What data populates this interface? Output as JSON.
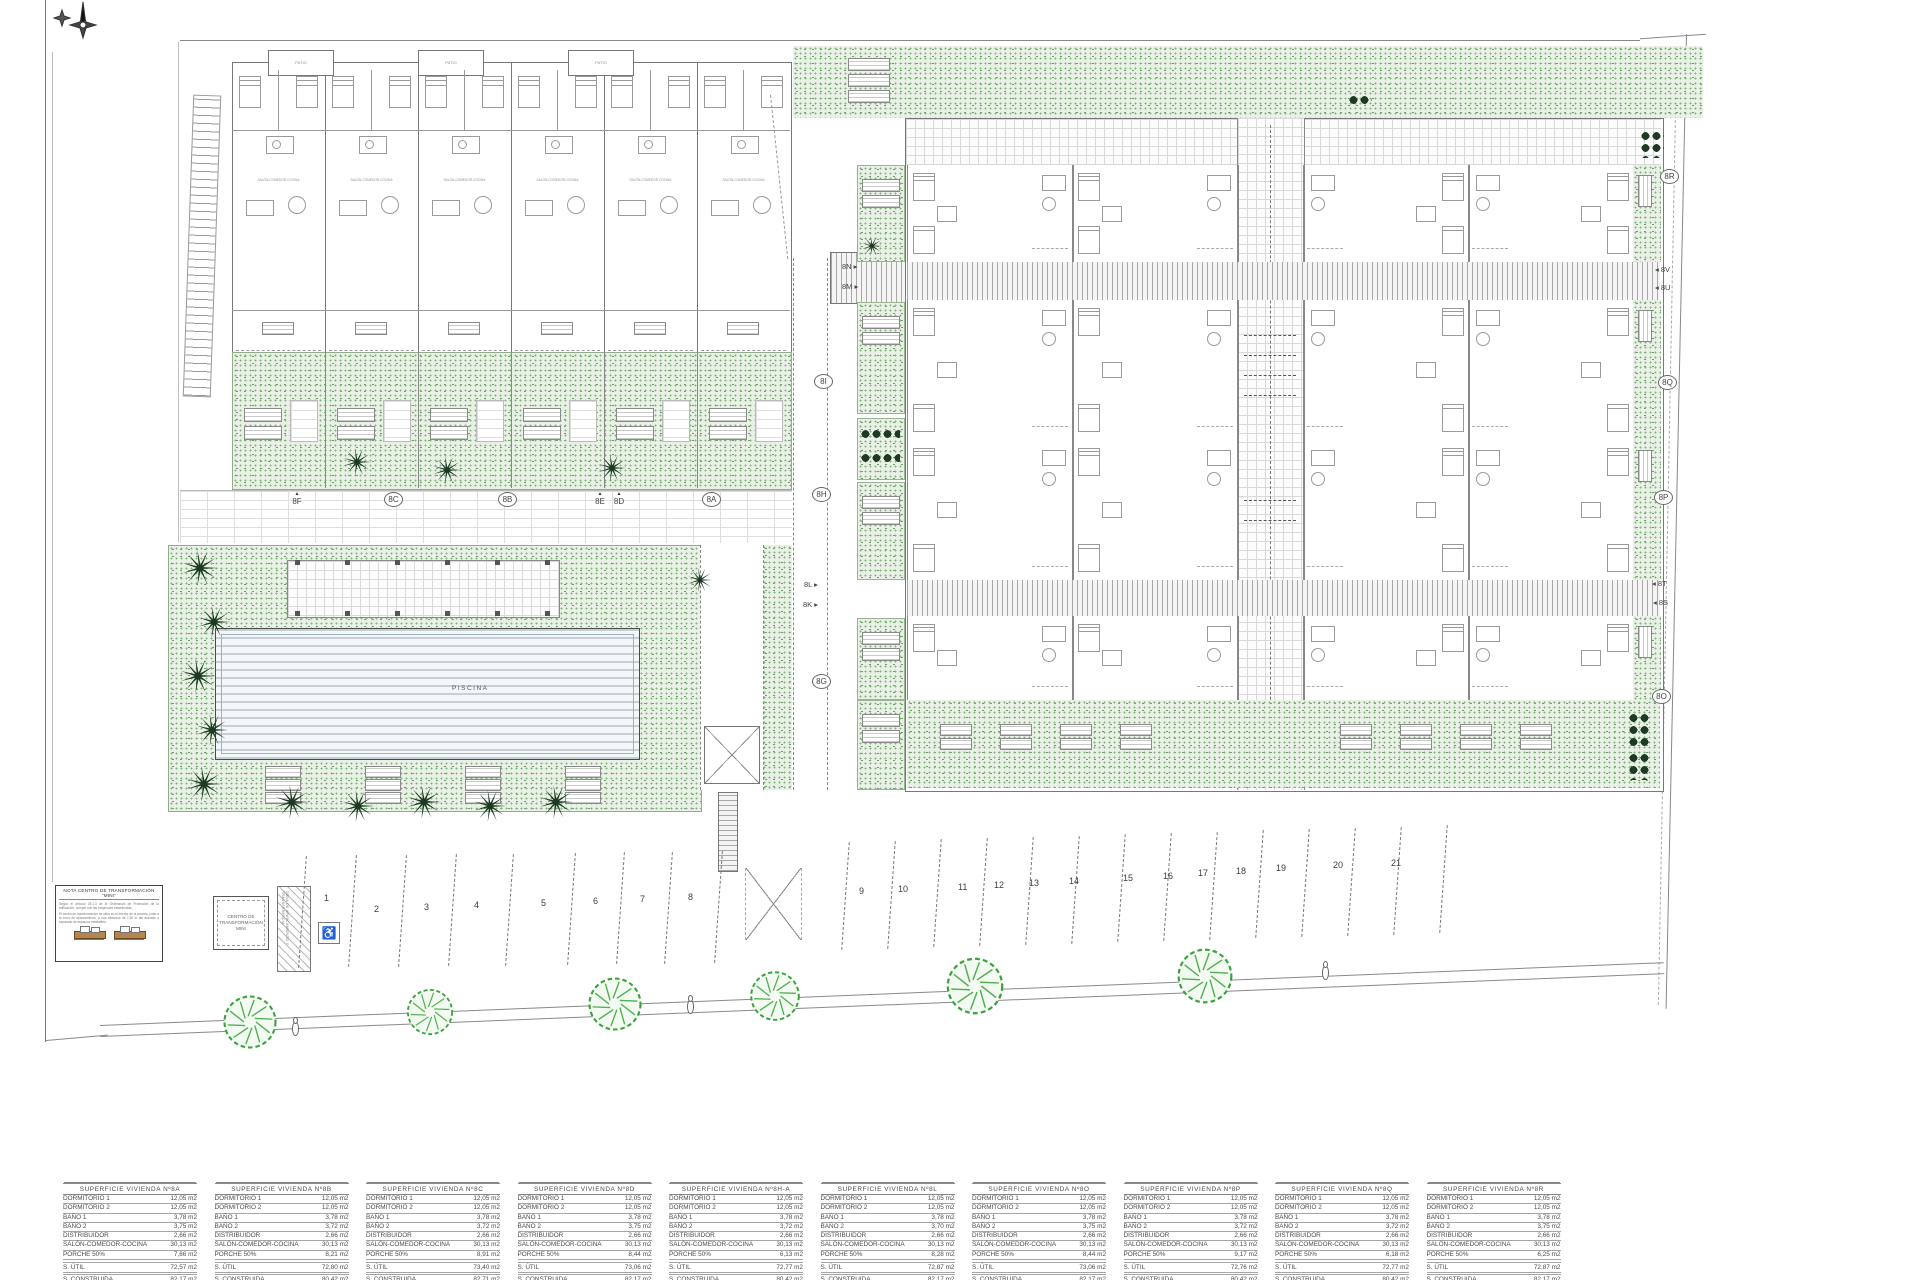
{
  "note_box": {
    "title": "NOTA CENTRO DE TRANSFORMACIÓN \"MINI\"",
    "par1": "Según el artículo 26.1.3 de la Ordenanza de Protección de la edificación, cumple con las exigencias establecidas.",
    "par2": "El centro de transformación se sitúa en el interior de la parcela, junto a la zona de aparcamiento, a una distancia de 1,50 m del acerado y separado de espacios habitables."
  },
  "transformer_label": "CENTRO DE TRANSFORMACIÓN MINI",
  "hatch_label": "ZONA DE APARCAMIENTO Y TRANSFERENCIA",
  "pool_label": "PISCINA",
  "patio_label": "PATIO",
  "salon_label": "SALÓN-COMEDOR-COCINA",
  "acera_label": "ACERA PERIMETRAL 2%",
  "parcel_label": "22",
  "compass_icon": "compass-north-icon",
  "wheelchair_symbol": "♿",
  "unit_labels": [
    {
      "text": "8F",
      "style": "tri",
      "x": 289,
      "y": 492
    },
    {
      "text": "8C",
      "style": "circle",
      "x": 384,
      "y": 492
    },
    {
      "text": "8B",
      "style": "circle",
      "x": 498,
      "y": 492
    },
    {
      "text": "8E",
      "style": "tri",
      "x": 592,
      "y": 492
    },
    {
      "text": "8D",
      "style": "tri",
      "x": 611,
      "y": 492
    },
    {
      "text": "8A",
      "style": "circle",
      "x": 702,
      "y": 492
    },
    {
      "text": "8N",
      "style": "arrow-r",
      "x": 842,
      "y": 262
    },
    {
      "text": "8M",
      "style": "arrow-r",
      "x": 842,
      "y": 282
    },
    {
      "text": "8I",
      "style": "circle",
      "x": 814,
      "y": 374
    },
    {
      "text": "8H",
      "style": "circle",
      "x": 812,
      "y": 487
    },
    {
      "text": "8L",
      "style": "arrow-r",
      "x": 804,
      "y": 580
    },
    {
      "text": "8K",
      "style": "arrow-r",
      "x": 803,
      "y": 600
    },
    {
      "text": "8G",
      "style": "circle",
      "x": 812,
      "y": 674
    },
    {
      "text": "8R",
      "style": "circle",
      "x": 1660,
      "y": 169
    },
    {
      "text": "8V",
      "style": "arrow-l",
      "x": 1655,
      "y": 265
    },
    {
      "text": "8U",
      "style": "arrow-l",
      "x": 1655,
      "y": 283
    },
    {
      "text": "8Q",
      "style": "circle",
      "x": 1658,
      "y": 375
    },
    {
      "text": "8P",
      "style": "circle",
      "x": 1654,
      "y": 490
    },
    {
      "text": "8T",
      "style": "arrow-l",
      "x": 1652,
      "y": 579
    },
    {
      "text": "8S",
      "style": "arrow-l",
      "x": 1653,
      "y": 598
    },
    {
      "text": "8O",
      "style": "circle",
      "x": 1652,
      "y": 689
    }
  ],
  "parking_numbers": [
    {
      "n": "1",
      "x": 328,
      "y": 899
    },
    {
      "n": "2",
      "x": 378,
      "y": 910
    },
    {
      "n": "3",
      "x": 428,
      "y": 908
    },
    {
      "n": "4",
      "x": 478,
      "y": 906
    },
    {
      "n": "5",
      "x": 545,
      "y": 904
    },
    {
      "n": "6",
      "x": 597,
      "y": 902
    },
    {
      "n": "7",
      "x": 644,
      "y": 900
    },
    {
      "n": "8",
      "x": 692,
      "y": 898
    },
    {
      "n": "9",
      "x": 863,
      "y": 892
    },
    {
      "n": "10",
      "x": 902,
      "y": 890
    },
    {
      "n": "11",
      "x": 962,
      "y": 888
    },
    {
      "n": "12",
      "x": 998,
      "y": 886
    },
    {
      "n": "13",
      "x": 1033,
      "y": 884
    },
    {
      "n": "14",
      "x": 1073,
      "y": 882
    },
    {
      "n": "15",
      "x": 1127,
      "y": 879
    },
    {
      "n": "16",
      "x": 1167,
      "y": 877
    },
    {
      "n": "17",
      "x": 1202,
      "y": 874
    },
    {
      "n": "18",
      "x": 1240,
      "y": 872
    },
    {
      "n": "19",
      "x": 1280,
      "y": 869
    },
    {
      "n": "20",
      "x": 1337,
      "y": 866
    },
    {
      "n": "21",
      "x": 1395,
      "y": 864
    }
  ],
  "area_tables": {
    "row_labels": [
      "DORMITORIO 1",
      "DORMITORIO 2",
      "BAÑO 1",
      "BAÑO 2",
      "DISTRIBUIDOR",
      "SALÓN-COMEDOR-COCINA",
      "PORCHE   50%",
      "S. ÚTIL",
      "S. CONSTRUIDA"
    ],
    "tables": [
      {
        "title": "SUPERFICIE VIVIENDA Nº8A",
        "values": [
          "12,05 m2",
          "12,05 m2",
          "3,78 m2",
          "3,75 m2",
          "2,66 m2",
          "30,13 m2",
          "7,66 m2",
          "72,57 m2",
          "82,17 m2"
        ]
      },
      {
        "title": "SUPERFICIE VIVIENDA Nº8B",
        "values": [
          "12,05 m2",
          "12,05 m2",
          "3,78 m2",
          "3,72 m2",
          "2,66 m2",
          "30,13 m2",
          "8,21 m2",
          "72,80 m2",
          "80,42 m2"
        ]
      },
      {
        "title": "SUPERFICIE VIVIENDA Nº8C",
        "values": [
          "12,05 m2",
          "12,05 m2",
          "3,78 m2",
          "3,72 m2",
          "2,66 m2",
          "30,13 m2",
          "8,91 m2",
          "73,40 m2",
          "82,71 m2"
        ]
      },
      {
        "title": "SUPERFICIE VIVIENDA Nº8D",
        "values": [
          "12,05 m2",
          "12,05 m2",
          "3,78 m2",
          "3,75 m2",
          "2,66 m2",
          "30,13 m2",
          "8,44 m2",
          "73,06 m2",
          "82,17 m2"
        ]
      },
      {
        "title": "SUPERFICIE VIVIENDA Nº8H-A",
        "values": [
          "12,05 m2",
          "12,05 m2",
          "3,78 m2",
          "3,72 m2",
          "2,66 m2",
          "30,13 m2",
          "6,13 m2",
          "72,77 m2",
          "80,42 m2"
        ]
      },
      {
        "title": "SUPERFICIE VIVIENDA Nº8L",
        "values": [
          "12,05 m2",
          "12,05 m2",
          "3,78 m2",
          "3,70 m2",
          "2,66 m2",
          "30,13 m2",
          "8,28 m2",
          "72,87 m2",
          "82,17 m2"
        ]
      },
      {
        "title": "SUPERFICIE VIVIENDA Nº8O",
        "values": [
          "12,05 m2",
          "12,05 m2",
          "3,78 m2",
          "3,75 m2",
          "2,66 m2",
          "30,13 m2",
          "8,44 m2",
          "73,06 m2",
          "82,17 m2"
        ]
      },
      {
        "title": "SUPERFICIE VIVIENDA Nº8P",
        "values": [
          "12,05 m2",
          "12,05 m2",
          "3,78 m2",
          "3,72 m2",
          "2,66 m2",
          "30,13 m2",
          "9,17 m2",
          "72,76 m2",
          "80,42 m2"
        ]
      },
      {
        "title": "SUPERFICIE VIVIENDA Nº8Q",
        "values": [
          "12,05 m2",
          "12,05 m2",
          "3,78 m2",
          "3,72 m2",
          "2,66 m2",
          "30,13 m2",
          "6,18 m2",
          "72,77 m2",
          "80,42 m2"
        ]
      },
      {
        "title": "SUPERFICIE VIVIENDA Nº8R",
        "values": [
          "12,05 m2",
          "12,05 m2",
          "3,78 m2",
          "3,75 m2",
          "2,66 m2",
          "30,13 m2",
          "6,25 m2",
          "72,87 m2",
          "82,17 m2"
        ]
      }
    ]
  },
  "colors": {
    "garden_green": "#84b27e",
    "dark_foliage": "#1e3a24",
    "tree_green": "#3aa23a",
    "tan": "#b5854f",
    "line_gray": "#777777"
  }
}
